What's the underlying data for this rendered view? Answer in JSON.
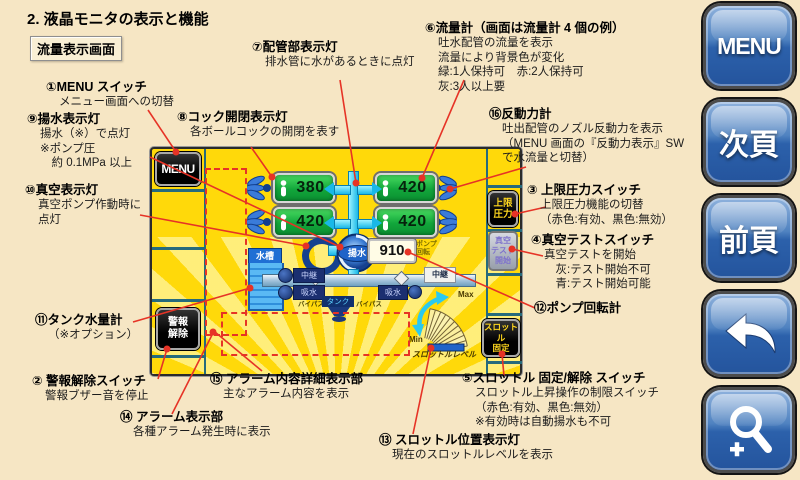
{
  "page": {
    "title": "2. 液晶モニタの表示と機能",
    "screen_label": "流量表示画面"
  },
  "colors": {
    "background_cream": "#f6e6c4",
    "panel_yellow": "#ffd90a",
    "pointer_red": "#e63326",
    "meter_green": "#12a73b",
    "button_blue": "#2c61ab",
    "switch_text_yellow": "#ffd71e"
  },
  "sidebar": {
    "menu_label": "MENU",
    "next_label": "次頁",
    "prev_label": "前頁",
    "back_icon": "back-arrow",
    "zoom_icon": "magnifier-plus"
  },
  "panel": {
    "menu_button": "MENU",
    "alarm_release_switch": "警報\n解除",
    "upper_limit_switch": "上限\n圧力",
    "vacuum_test_switch": "真空\nテスト\n開始",
    "throttle_lock_switch": "スロットル\n固定",
    "flow_meters": [
      "380",
      "420",
      "420",
      "420"
    ],
    "pump_label": "揚水",
    "rpm_value": "910",
    "rpm_label": "ポンプ\n回転",
    "tank_label": "水槽",
    "relay_left": "中継",
    "suction_left": "吸水",
    "suction_right": "吸水",
    "relay_right": "中継",
    "bypass_left": "バイパス",
    "bypass_right": "バイパス",
    "tank_connector": "タンク",
    "throttle_max": "Max",
    "throttle_min": "Min",
    "throttle_scale_label": "スロットルレベル"
  },
  "annotations": [
    {
      "title": "①MENU スイッチ",
      "lines": [
        "メニュー画面への切替"
      ]
    },
    {
      "title": "⑨揚水表示灯",
      "lines": [
        "揚水（※）で点灯",
        "※ポンプ圧",
        "　約 0.1MPa 以上"
      ]
    },
    {
      "title": "⑩真空表示灯",
      "lines": [
        "真空ポンプ作動時に",
        "点灯"
      ]
    },
    {
      "title": "⑪タンク水量計",
      "lines": [
        "（※オプション）"
      ]
    },
    {
      "title": "② 警報解除スイッチ",
      "lines": [
        "警報ブザー音を停止"
      ]
    },
    {
      "title": "⑭ アラーム表示部",
      "lines": [
        "各種アラーム発生時に表示"
      ]
    },
    {
      "title": "⑮ アラーム内容詳細表示部",
      "lines": [
        "主なアラーム内容を表示"
      ]
    },
    {
      "title": "⑦配管部表示灯",
      "lines": [
        "排水管に水があるときに点灯"
      ]
    },
    {
      "title": "⑧コック開閉表示灯",
      "lines": [
        "各ボールコックの開閉を表す"
      ]
    },
    {
      "title": "⑥流量計（画面は流量計 4 個の例）",
      "lines": [
        "吐水配管の流量を表示",
        "流量により背景色が変化",
        "緑:1人保持可　赤:2人保持可",
        "灰:3人以上要"
      ]
    },
    {
      "title": "⑯反動力計",
      "lines": [
        "吐出配管のノズル反動力を表示",
        "（MENU 画面の『反動力表示』SW",
        "で水流量と切替）"
      ]
    },
    {
      "title": "③ 上限圧力スイッチ",
      "lines": [
        "上限圧力機能の切替",
        "（赤色:有効、黒色:無効）"
      ]
    },
    {
      "title": "④真空テストスイッチ",
      "lines": [
        "真空テストを開始",
        "　灰:テスト開始不可",
        "　青:テスト開始可能"
      ]
    },
    {
      "title": "⑫ポンプ回転計",
      "lines": []
    },
    {
      "title": "⑤スロットル 固定/解除 スイッチ",
      "lines": [
        "スロットル上昇操作の制限スイッチ",
        "（赤色:有効、黒色:無効）",
        "※有効時は自動揚水も不可"
      ]
    },
    {
      "title": "⑬ スロットル位置表示灯",
      "lines": [
        "現在のスロットルレベルを表示"
      ]
    }
  ]
}
